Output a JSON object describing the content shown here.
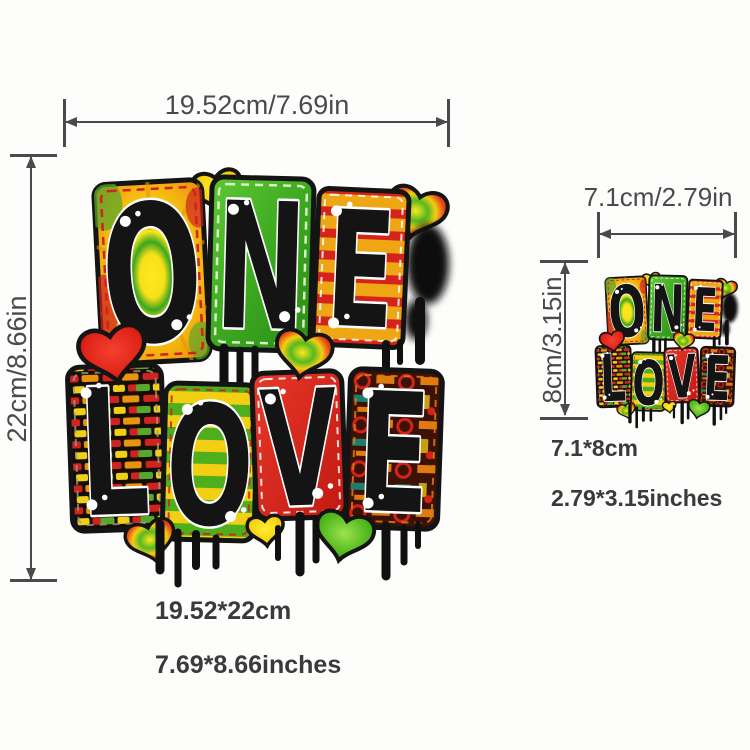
{
  "page": {
    "background_color": "#fdfdfb"
  },
  "colors": {
    "dimension": "#4a4a4c",
    "size_text": "#3a3a3c",
    "ink": "#141414",
    "rasta_red": "#d5231a",
    "rasta_orange": "#ee9d12",
    "rasta_yellow": "#f2cf12",
    "rasta_green": "#3aa61f"
  },
  "artwork": {
    "letters_one": [
      "O",
      "N",
      "E"
    ],
    "letters_love": [
      "L",
      "O",
      "V",
      "E"
    ]
  },
  "main_item": {
    "width_label": "19.52cm/7.69in",
    "height_label": "22cm/8.66in",
    "size_cm": "19.52*22cm",
    "size_in": "7.69*8.66inches"
  },
  "small_item": {
    "width_label": "7.1cm/2.79in",
    "height_label": "8cm/3.15in",
    "size_cm": "7.1*8cm",
    "size_in": "2.79*3.15inches"
  }
}
